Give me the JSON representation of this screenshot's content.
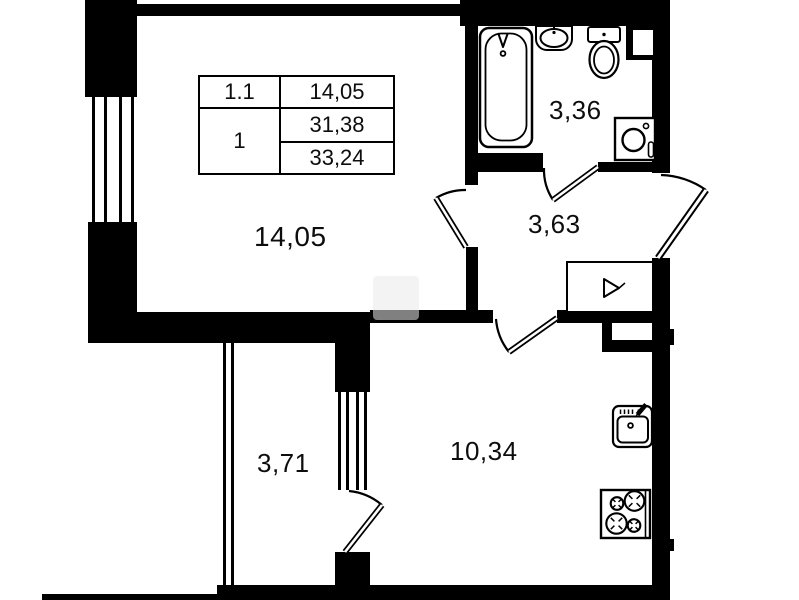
{
  "info_table": {
    "r1c1": "1.1",
    "r1c2": "14,05",
    "r2c1": "1",
    "r2c2": "31,38",
    "r3c2": "33,24"
  },
  "rooms": {
    "living": {
      "area": "14,05"
    },
    "bathroom": {
      "area": "3,36"
    },
    "hallway": {
      "area": "3,63"
    },
    "corridor": {
      "area": "3,71"
    },
    "kitchen": {
      "area": "10,34"
    }
  },
  "icons": {
    "bathtub-icon": "rounded-rect tub with faucet",
    "wash-basin-icon": "oval basin on bracket",
    "toilet-icon": "cistern rectangle with oval bowl",
    "washing-machine-icon": "square with porthole circle",
    "kitchen-sink-icon": "square basin with tap",
    "stove-icon": "square with four burners",
    "electric-panel-icon": "rectangle with triangle mark",
    "door-swing-icon": "leaf line with quarter arc",
    "window-icon": "four parallel glazing lines"
  },
  "colors": {
    "wall": "#000000",
    "background": "#ffffff",
    "text": "#0d0d0d"
  }
}
